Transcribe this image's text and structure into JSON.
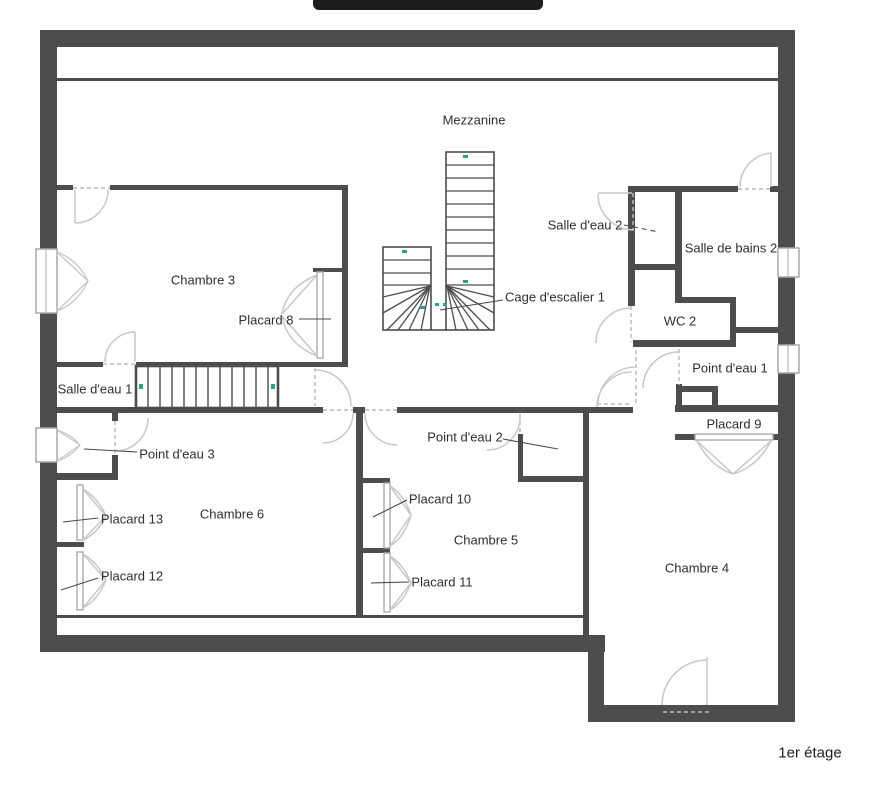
{
  "floor_title": "1er étage",
  "labels": {
    "mezzanine": "Mezzanine",
    "chambre3": "Chambre 3",
    "placard8": "Placard 8",
    "salle_eau1": "Salle d'eau 1",
    "cage": "Cage d'escalier 1",
    "salle_eau2": "Salle d'eau 2",
    "sdb2": "Salle de bains 2",
    "wc2": "WC 2",
    "pde1": "Point d'eau 1",
    "placard9": "Placard 9",
    "pde3": "Point d'eau 3",
    "placard13": "Placard 13",
    "chambre6": "Chambre 6",
    "placard12": "Placard 12",
    "pde2": "Point d'eau 2",
    "placard10": "Placard 10",
    "chambre5": "Chambre 5",
    "placard11": "Placard 11",
    "chambre4": "Chambre 4"
  },
  "colors": {
    "wall": "#4d4d4d",
    "door": "#c8c8c8",
    "dashed": "#bcbcbc",
    "label": "#2f2f2f",
    "stair_mark": "#2fa08e",
    "top_bar": "#1d1d1d"
  }
}
